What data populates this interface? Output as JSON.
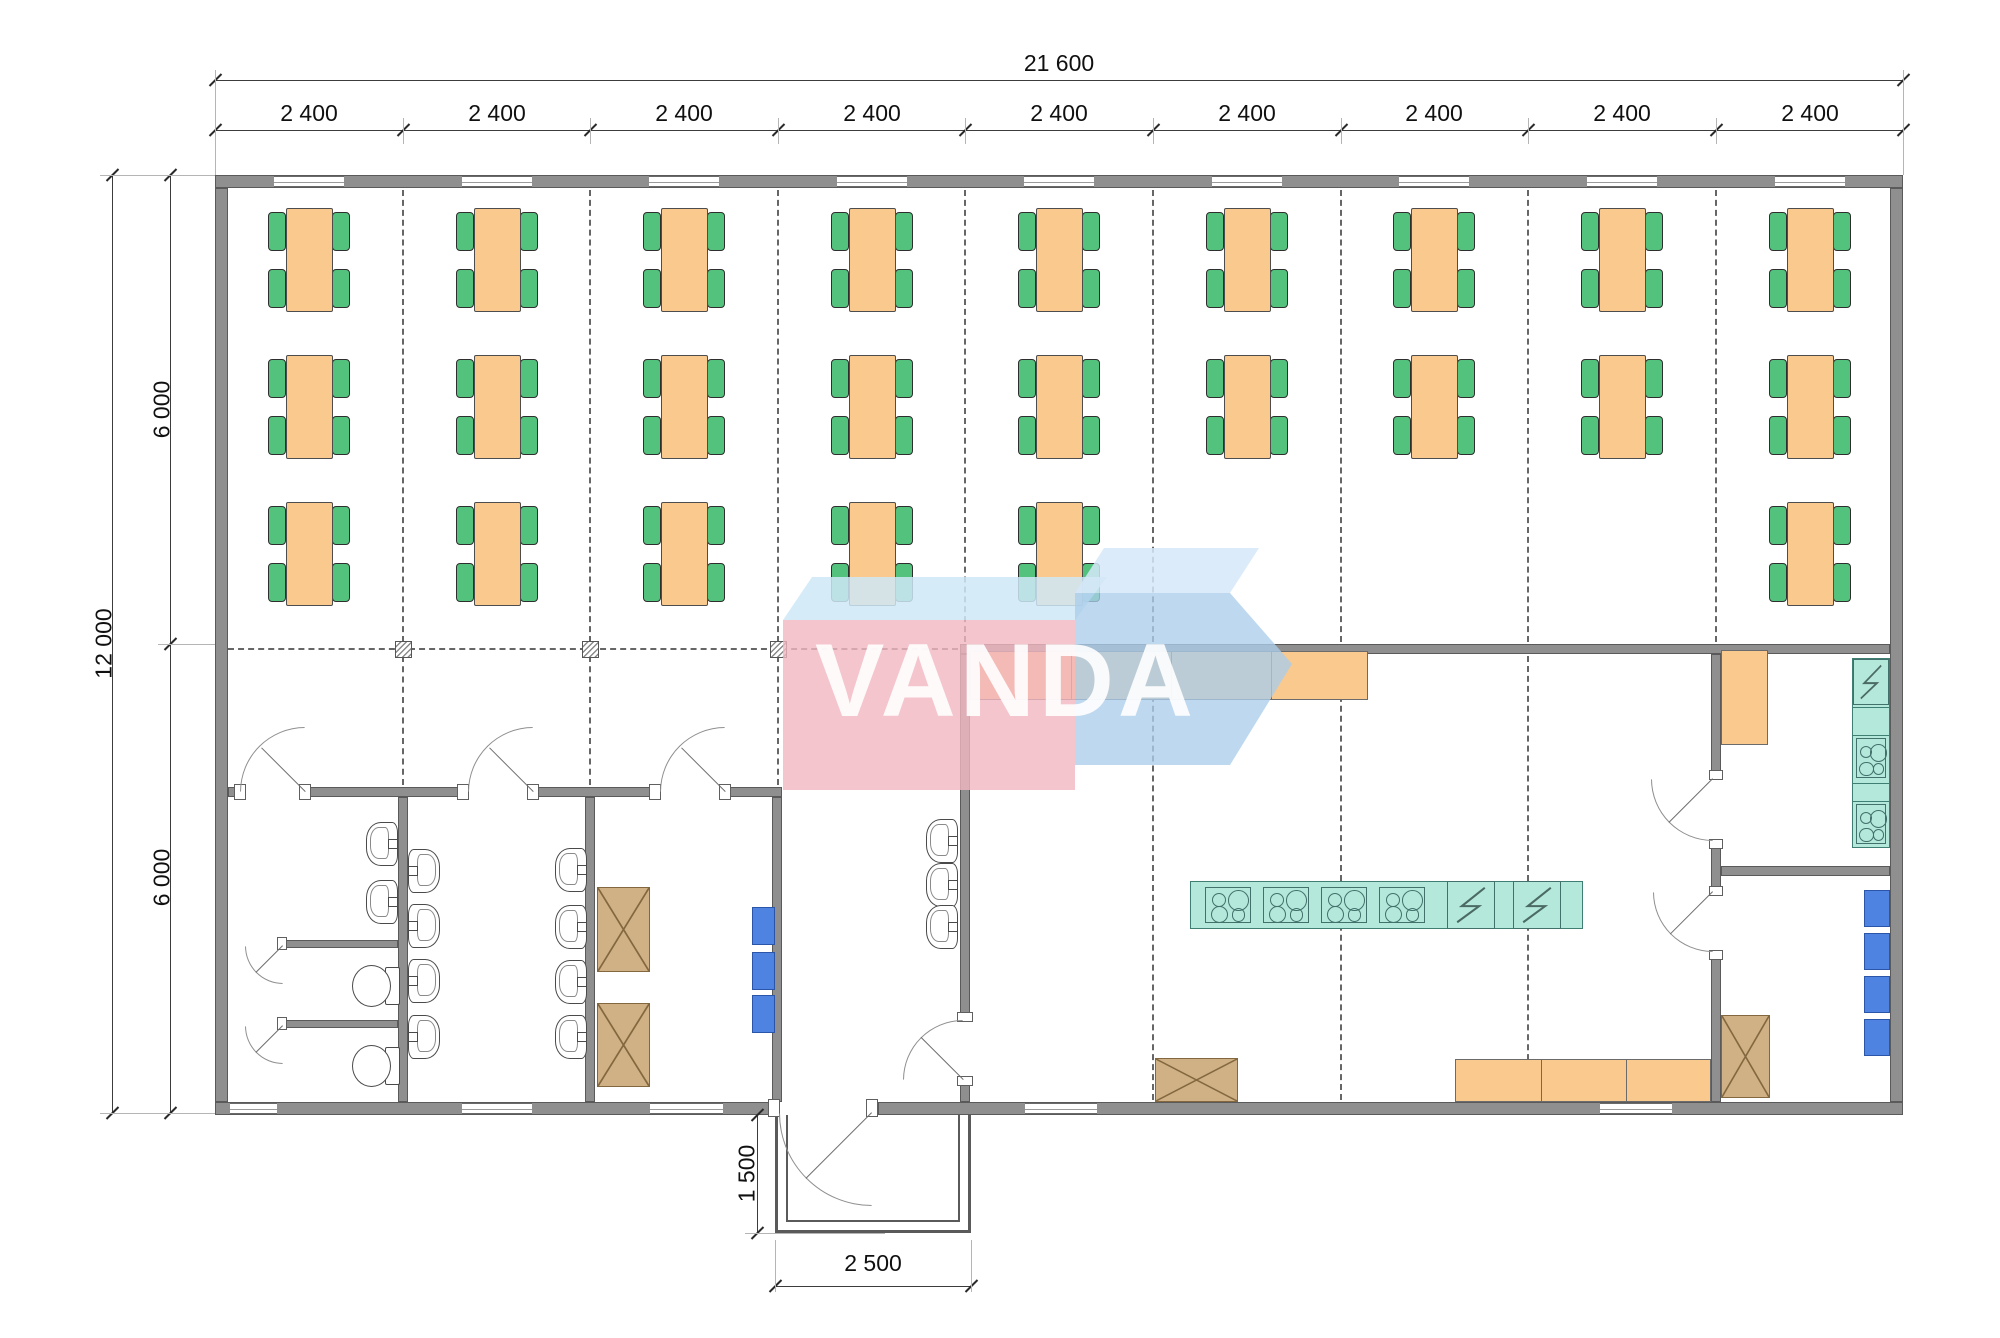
{
  "document": {
    "type": "architectural floor plan",
    "description": "canteen / dining hall module plan"
  },
  "watermark": {
    "text": "VANDA"
  },
  "dimensions": {
    "overall_width": "21 600",
    "top_segments": [
      "2 400",
      "2 400",
      "2 400",
      "2 400",
      "2 400",
      "2 400",
      "2 400",
      "2 400",
      "2 400"
    ],
    "overall_height": "12 000",
    "left_segments": [
      "6 000",
      "6 000"
    ],
    "porch_depth": "1 500",
    "porch_width": "2 500"
  },
  "colors": {
    "wall": "#8f8f8f",
    "table": "#f9c98d",
    "chair": "#53c27d",
    "counter_orange": "#f9c98d",
    "appliance_teal": "#b4e8db",
    "cabinet_tan": "#d0b185",
    "locker_blue": "#4f83e2",
    "watermark_pink": "#f2b7c0",
    "watermark_blue": "#b6d3ec",
    "watermark_light": "#cfe7f7"
  },
  "plan": {
    "grid": {
      "xs": [
        215,
        403,
        590,
        778,
        965,
        1153,
        1341,
        1528,
        1716,
        1903
      ],
      "bay_centers": [
        309,
        497,
        684,
        872,
        1059,
        1247,
        1434,
        1622,
        1810
      ]
    },
    "walls": [
      [
        215,
        175,
        1688,
        13
      ],
      [
        215,
        1102,
        560,
        13
      ],
      [
        878,
        1102,
        1025,
        13
      ],
      [
        215,
        188,
        13,
        914
      ],
      [
        1890,
        188,
        13,
        914
      ],
      [
        960,
        644,
        930,
        10
      ],
      [
        228,
        787,
        12,
        10
      ],
      [
        305,
        787,
        158,
        10
      ],
      [
        533,
        787,
        122,
        10
      ],
      [
        725,
        787,
        57,
        10
      ],
      [
        398,
        797,
        10,
        305
      ],
      [
        585,
        797,
        10,
        305
      ],
      [
        772,
        797,
        10,
        305
      ],
      [
        960,
        654,
        10,
        364
      ],
      [
        960,
        1080,
        10,
        22
      ],
      [
        1711,
        654,
        10,
        123
      ],
      [
        1711,
        842,
        10,
        48
      ],
      [
        1711,
        953,
        10,
        149
      ],
      [
        1721,
        866,
        169,
        10
      ],
      [
        283,
        940,
        115,
        8
      ],
      [
        283,
        1020,
        115,
        8
      ]
    ],
    "windows_top_x": [
      274,
      462,
      649,
      837,
      1024,
      1212,
      1399,
      1587,
      1775
    ],
    "windows_bottom": [
      [
        230,
        47
      ],
      [
        462,
        70
      ],
      [
        650,
        73
      ],
      [
        1025,
        72
      ],
      [
        1600,
        72
      ]
    ],
    "posts": [
      [
        234,
        784,
        12,
        16
      ],
      [
        299,
        784,
        12,
        16
      ],
      [
        457,
        784,
        12,
        16
      ],
      [
        527,
        784,
        12,
        16
      ],
      [
        649,
        784,
        12,
        16
      ],
      [
        719,
        784,
        12,
        16
      ],
      [
        768,
        1099,
        12,
        18
      ],
      [
        866,
        1099,
        12,
        18
      ],
      [
        957,
        1012,
        16,
        10
      ],
      [
        957,
        1076,
        16,
        10
      ],
      [
        1709,
        770,
        14,
        10
      ],
      [
        1709,
        839,
        14,
        10
      ],
      [
        1709,
        886,
        14,
        10
      ],
      [
        1709,
        950,
        14,
        10
      ],
      [
        277,
        937,
        10,
        13
      ],
      [
        277,
        1017,
        10,
        13
      ]
    ],
    "doors": [
      {
        "h": [
          305,
          792
        ],
        "a": 225,
        "l": 62,
        "arc": [
          240,
          727,
          65
        ],
        "c": "tl"
      },
      {
        "h": [
          533,
          792
        ],
        "a": 225,
        "l": 62,
        "arc": [
          468,
          727,
          65
        ],
        "c": "tl"
      },
      {
        "h": [
          725,
          792
        ],
        "a": 225,
        "l": 62,
        "arc": [
          660,
          727,
          65
        ],
        "c": "tl"
      },
      {
        "h": [
          283,
          946
        ],
        "a": 135,
        "l": 38,
        "arc": [
          245,
          946,
          38
        ],
        "c": "bl"
      },
      {
        "h": [
          283,
          1026
        ],
        "a": 135,
        "l": 38,
        "arc": [
          245,
          1026,
          38
        ],
        "c": "bl"
      },
      {
        "h": [
          872,
          1113
        ],
        "a": 135,
        "l": 93,
        "arc": [
          779,
          1113,
          93
        ],
        "c": "bl"
      },
      {
        "h": [
          963,
          1080
        ],
        "a": 225,
        "l": 60,
        "arc": [
          903,
          1020,
          60
        ],
        "c": "tl"
      },
      {
        "h": [
          1713,
          779
        ],
        "a": 135,
        "l": 62,
        "arc": [
          1651,
          779,
          62
        ],
        "c": "bl"
      },
      {
        "h": [
          1713,
          892
        ],
        "a": 135,
        "l": 60,
        "arc": [
          1653,
          892,
          60
        ],
        "c": "bl"
      }
    ],
    "dashed_v": [
      {
        "x": 403,
        "y1": 190,
        "y2": 642
      },
      {
        "x": 590,
        "y1": 190,
        "y2": 642
      },
      {
        "x": 778,
        "y1": 190,
        "y2": 642
      },
      {
        "x": 965,
        "y1": 190,
        "y2": 642
      },
      {
        "x": 1153,
        "y1": 190,
        "y2": 642
      },
      {
        "x": 1341,
        "y1": 190,
        "y2": 642
      },
      {
        "x": 1528,
        "y1": 190,
        "y2": 642
      },
      {
        "x": 1716,
        "y1": 190,
        "y2": 642
      },
      {
        "x": 403,
        "y1": 656,
        "y2": 785
      },
      {
        "x": 590,
        "y1": 656,
        "y2": 785
      },
      {
        "x": 778,
        "y1": 656,
        "y2": 785
      },
      {
        "x": 1153,
        "y1": 656,
        "y2": 1100
      },
      {
        "x": 1341,
        "y1": 656,
        "y2": 1100
      },
      {
        "x": 1528,
        "y1": 656,
        "y2": 1100
      }
    ],
    "dashed_h": [
      {
        "y": 649,
        "x1": 228,
        "x2": 958
      }
    ],
    "columns": [
      [
        395,
        641
      ],
      [
        582,
        641
      ],
      [
        770,
        641
      ]
    ],
    "dining": {
      "table_count": 24,
      "rows": [
        {
          "y": 208,
          "bays": [
            0,
            1,
            2,
            3,
            4,
            5,
            6,
            7,
            8
          ]
        },
        {
          "y": 355,
          "bays": [
            0,
            1,
            2,
            3,
            4,
            5,
            6,
            7,
            8
          ]
        },
        {
          "y": 502,
          "bays": [
            0,
            1,
            2,
            3,
            4,
            8
          ]
        }
      ]
    },
    "sinks": [
      [
        366,
        822,
        "l"
      ],
      [
        366,
        880,
        "l"
      ],
      [
        410,
        849,
        "r"
      ],
      [
        410,
        904,
        "r"
      ],
      [
        410,
        959,
        "r"
      ],
      [
        410,
        1015,
        "r"
      ],
      [
        555,
        848,
        "l"
      ],
      [
        555,
        905,
        "l"
      ],
      [
        555,
        960,
        "l"
      ],
      [
        555,
        1015,
        "l"
      ],
      [
        926,
        819,
        "l"
      ],
      [
        926,
        863,
        "l"
      ],
      [
        926,
        905,
        "l"
      ]
    ],
    "toilets": [
      [
        352,
        963
      ],
      [
        352,
        1043
      ]
    ],
    "cabinets_x": [
      [
        597,
        887,
        53,
        85
      ],
      [
        597,
        1003,
        53,
        84
      ],
      [
        1155,
        1058,
        83,
        44
      ],
      [
        1721,
        1015,
        49,
        83
      ]
    ],
    "lockers": [
      [
        752,
        907,
        23,
        38
      ],
      [
        752,
        952,
        23,
        38
      ],
      [
        752,
        995,
        23,
        38
      ],
      [
        1864,
        890,
        26,
        37
      ],
      [
        1864,
        933,
        26,
        37
      ],
      [
        1864,
        976,
        26,
        37
      ],
      [
        1864,
        1019,
        26,
        37
      ]
    ],
    "counters": [
      {
        "x": 970,
        "y": 651,
        "w": 398,
        "h": 49,
        "divs": [
          100,
          200,
          300
        ]
      },
      {
        "x": 1455,
        "y": 1059,
        "w": 256,
        "h": 43,
        "divs": [
          85,
          170
        ]
      },
      {
        "x": 1721,
        "y": 650,
        "w": 47,
        "h": 95,
        "divs": []
      }
    ],
    "island": {
      "x": 1190,
      "y": 881,
      "w": 393,
      "h": 48,
      "stoves": [
        15,
        73,
        131,
        189
      ],
      "zaps": [
        257,
        323
      ]
    },
    "wall_counter": {
      "x": 1852,
      "y": 658,
      "w": 38,
      "h": 190,
      "dividers": [
        48,
        76,
        124,
        142
      ],
      "zap": [
        0,
        48
      ],
      "stoves": [
        76,
        142
      ]
    },
    "porch": {
      "outer": [
        775,
        1115,
        196,
        118
      ]
    }
  }
}
